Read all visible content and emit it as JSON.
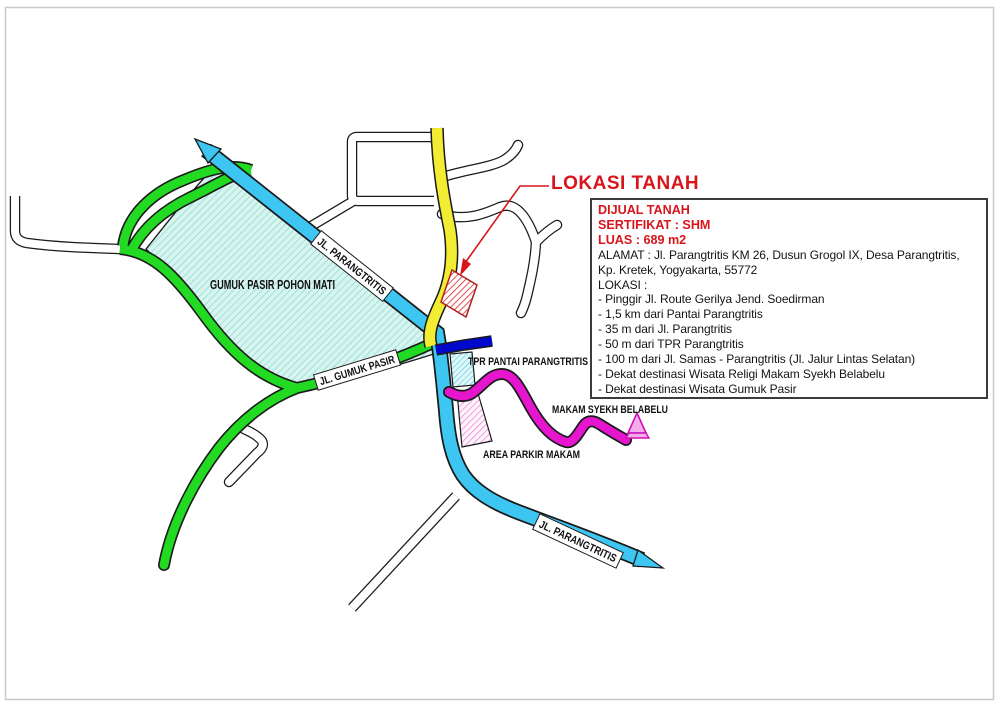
{
  "page": {
    "title": "LOKASI TANAH"
  },
  "info_box": {
    "dijual": "DIJUAL TANAH",
    "sertifikat": "SERTIFIKAT : SHM",
    "luas": "LUAS : 689 m2",
    "alamat_line1": "ALAMAT : Jl. Parangtritis KM 26, Dusun Grogol IX, Desa Parangtritis,",
    "alamat_line2": "Kp. Kretek, Yogyakarta, 55772",
    "lokasi_heading": "LOKASI :",
    "lokasi_items": [
      "- Pinggir Jl. Route Gerilya Jend. Soedirman",
      "- 1,5 km dari Pantai Parangtritis",
      "- 35 m dari Jl. Parangtritis",
      "- 50 m dari TPR Parangtritis",
      "- 100 m dari Jl. Samas - Parangtritis (Jl. Jalur Lintas Selatan)",
      "- Dekat destinasi Wisata Religi Makam Syekh Belabelu",
      "- Dekat destinasi Wisata Gumuk Pasir"
    ]
  },
  "map": {
    "labels": {
      "gumuk_pasir_area": "GUMUK PASIR POHON MATI",
      "jl_parangtritis_upper": "JL. PARANGTRITIS",
      "jl_parangtritis_lower": "JL. PARANGTRITIS",
      "jl_gumuk_pasir": "JL. GUMUK PASIR",
      "tpr": "TPR PANTAI PARANGTRITIS",
      "makam": "MAKAM SYEKH BELABELU",
      "area_parkir": "AREA PARKIR MAKAM"
    },
    "colors": {
      "road_parangtritis": "#3ec6f2",
      "road_gumuk_pasir": "#21da21",
      "road_gerilya": "#f2ec33",
      "road_tpr": "#0008cc",
      "road_makam": "#e616ce",
      "accent_red": "#d8151b",
      "gumuk_area_fill": "#d9f4ef"
    }
  }
}
